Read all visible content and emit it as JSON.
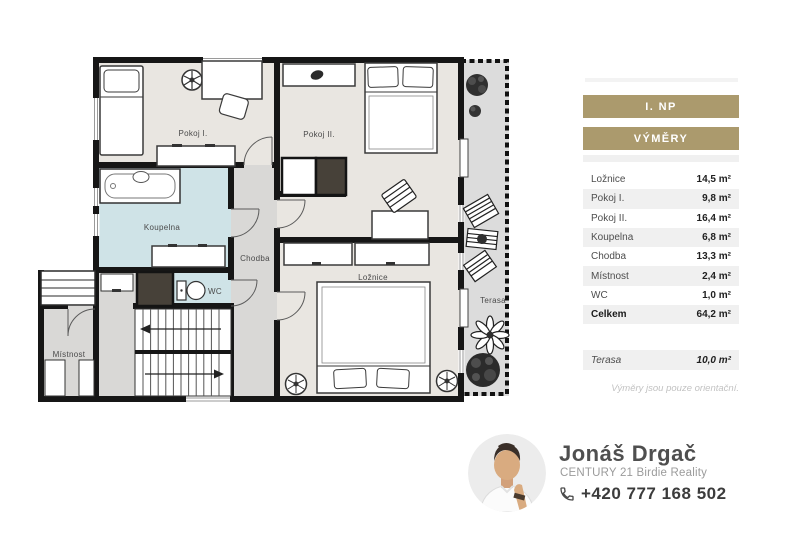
{
  "panel": {
    "floor_badge": "I. NP",
    "areas_badge": "VÝMĚRY",
    "rows": [
      {
        "label": "Ložnice",
        "value": "14,5 m²"
      },
      {
        "label": "Pokoj I.",
        "value": "9,8 m²"
      },
      {
        "label": "Pokoj II.",
        "value": "16,4 m²"
      },
      {
        "label": "Koupelna",
        "value": "6,8 m²"
      },
      {
        "label": "Chodba",
        "value": "13,3 m²"
      },
      {
        "label": "Místnost",
        "value": "2,4 m²"
      },
      {
        "label": "WC",
        "value": "1,0 m²"
      }
    ],
    "total_row": {
      "label": "Celkem",
      "value": "64,2 m²"
    },
    "terasa_row": {
      "label": "Terasa",
      "value": "10,0 m²"
    },
    "note": "Výměry jsou pouze orientační."
  },
  "floorplan": {
    "labels": {
      "pokoj1": "Pokoj I.",
      "pokoj2": "Pokoj II.",
      "koupelna": "Koupelna",
      "chodba": "Chodba",
      "wc": "WC",
      "loznice": "Ložnice",
      "mistnost": "Místnost",
      "terasa": "Terasa"
    }
  },
  "agent": {
    "name": "Jonáš Drgač",
    "company": "CENTURY 21 Birdie Reality",
    "phone": "+420 777 168 502"
  },
  "colors": {
    "accent": "#ab9a6d",
    "row_stripe": "#f0f0f0",
    "wall": "#161616",
    "floor_fill": "#e9e6e1",
    "bathroom_fill": "#cfe3e7",
    "corridor_fill": "#d9d8d6",
    "terrace_fill": "#dcdcdc"
  }
}
